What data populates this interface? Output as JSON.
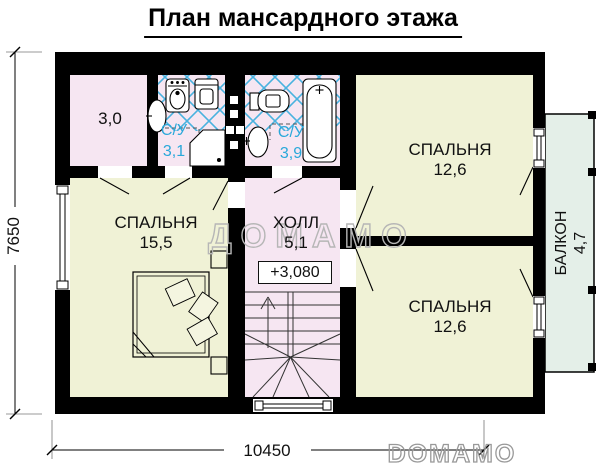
{
  "title": "План мансардного этажа",
  "plan": {
    "storage_area": "3,0",
    "bath1_label": "С/У",
    "bath1_area": "3,1",
    "bath2_label": "С/У",
    "bath2_area": "3,9",
    "bedroom_left_label": "СПАЛЬНЯ",
    "bedroom_left_area": "15,5",
    "hall_label": "ХОЛЛ",
    "hall_area": "5,1",
    "elevation_mark": "+3,080",
    "bedroom_top_label": "СПАЛЬНЯ",
    "bedroom_top_area": "12,6",
    "bedroom_bottom_label": "СПАЛЬНЯ",
    "bedroom_bottom_area": "12,6",
    "balcony_label": "БАЛКОН",
    "balcony_area": "4,7"
  },
  "dimensions": {
    "overall_width_mm": "10450",
    "overall_depth_mm": "7650"
  },
  "watermarks": {
    "center": "ДОМАМО",
    "corner": "DOMAMO"
  },
  "colors": {
    "wall_black": "#000000",
    "room_pink": "#f6e6f2",
    "room_yellow": "#f0f2d6",
    "balcony_green": "#e4efe8",
    "tile_blue": "#49b2df",
    "bath_text_cyan": "#29a8da",
    "watermark_gray": "#b6b6b6"
  }
}
